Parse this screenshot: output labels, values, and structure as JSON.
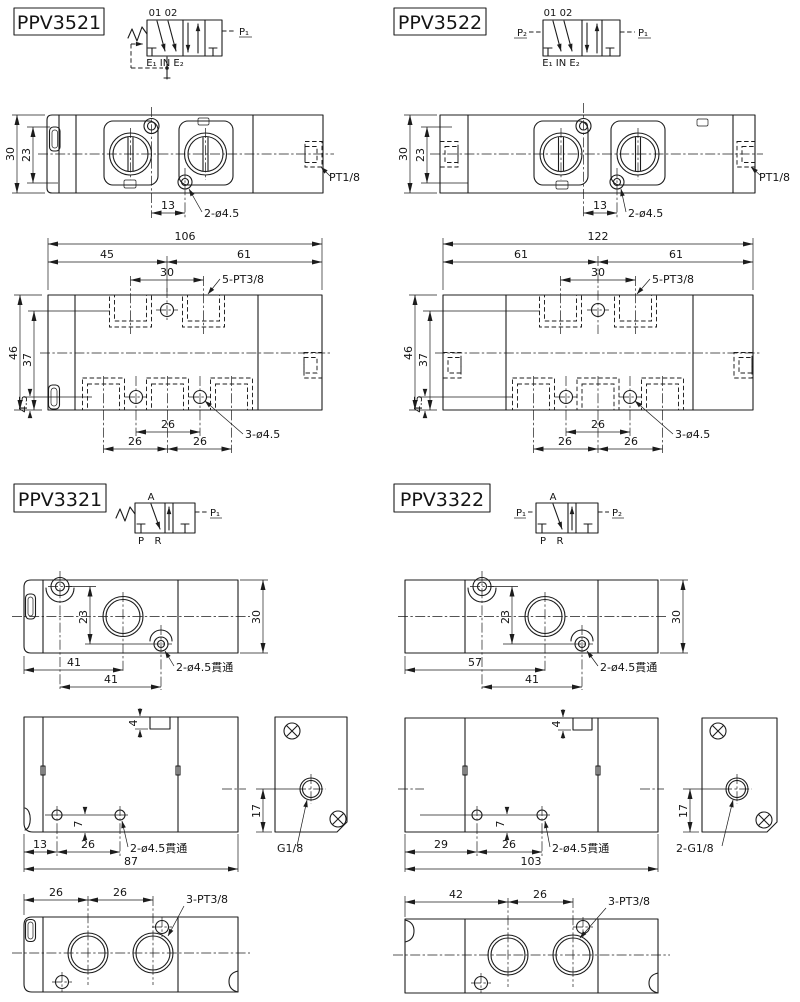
{
  "page": {
    "background": "#ffffff",
    "line_color": "#1c1c1c"
  },
  "ppv3521": {
    "title": "PPV3521",
    "symbol": {
      "top_ports": "01 02",
      "right_port": "P₁",
      "bottom_ports": "E₁ IN E₂"
    },
    "plan": {
      "height": "30",
      "inner_height": "23",
      "offset": "13",
      "holes": "2-ø4.5",
      "side_port": "PT1/8"
    },
    "manifold": {
      "width": "106",
      "left_span": "45",
      "right_span": "61",
      "port_span": "30",
      "ports": "5-PT3/8",
      "height": "46",
      "inner_height": "37",
      "edge_offset": "4.5",
      "span_mid": "26",
      "span_left": "26",
      "span_right": "26",
      "holes": "3-ø4.5"
    }
  },
  "ppv3522": {
    "title": "PPV3522",
    "symbol": {
      "top_ports": "01 02",
      "left_port": "P₂",
      "right_port": "P₁",
      "bottom_ports": "E₁ IN E₂"
    },
    "plan": {
      "height": "30",
      "inner_height": "23",
      "offset": "13",
      "holes": "2-ø4.5",
      "side_port": "PT1/8"
    },
    "manifold": {
      "width": "122",
      "left_span": "61",
      "right_span": "61",
      "port_span": "30",
      "ports": "5-PT3/8",
      "height": "46",
      "inner_height": "37",
      "edge_offset": "4.5",
      "span_mid": "26",
      "span_left": "26",
      "span_right": "26",
      "holes": "3-ø4.5"
    }
  },
  "ppv3321": {
    "title": "PPV3321",
    "symbol": {
      "top_port": "A",
      "right_port": "P₁",
      "bottom_left": "P",
      "bottom_right": "R"
    },
    "plan": {
      "inner_height": "23",
      "height": "30",
      "span_a": "41",
      "span_b": "41",
      "holes": "2-ø4.5貫通"
    },
    "front": {
      "notch": "4",
      "hole_offset": "7",
      "span_a": "13",
      "span_b": "26",
      "holes": "2-ø4.5貫通",
      "width": "87"
    },
    "side": {
      "port_offset": "17",
      "port": "G1/8"
    },
    "bottom": {
      "span_a": "26",
      "span_b": "26",
      "ports": "3-PT3/8"
    }
  },
  "ppv3322": {
    "title": "PPV3322",
    "symbol": {
      "top_port": "A",
      "left_port": "P₁",
      "right_port": "P₂",
      "bottom_left": "P",
      "bottom_right": "R"
    },
    "plan": {
      "inner_height": "23",
      "height": "30",
      "span_a": "57",
      "span_b": "41",
      "holes": "2-ø4.5貫通"
    },
    "front": {
      "notch": "4",
      "hole_offset": "7",
      "span_a": "29",
      "span_b": "26",
      "holes": "2-ø4.5貫通",
      "width": "103"
    },
    "side": {
      "port_offset": "17",
      "port": "2-G1/8"
    },
    "bottom": {
      "span_a": "42",
      "span_b": "26",
      "ports": "3-PT3/8"
    }
  }
}
